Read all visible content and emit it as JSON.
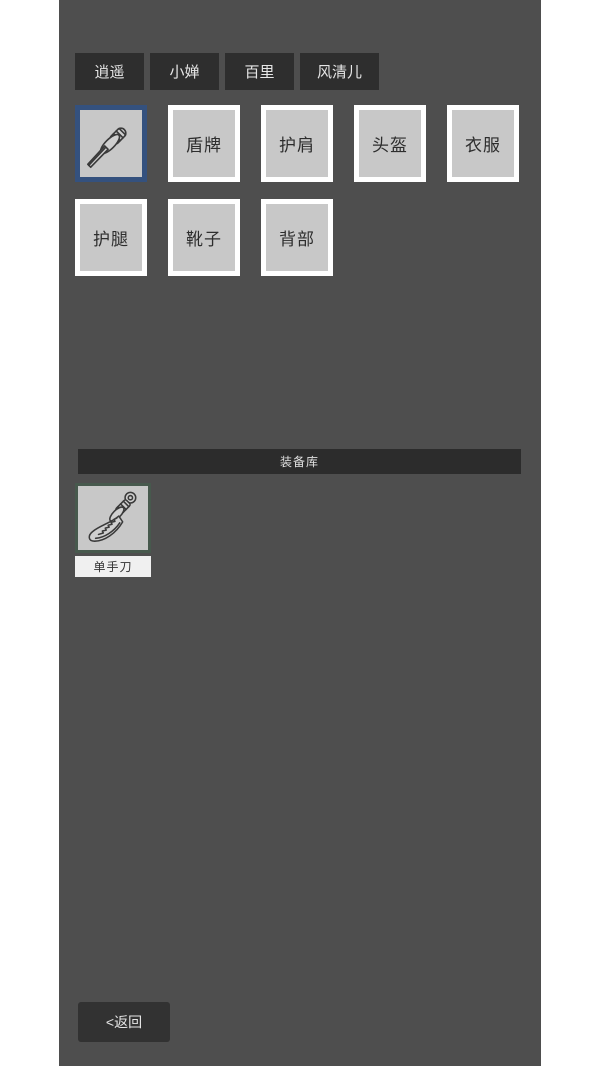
{
  "tabs": [
    {
      "label": "逍遥"
    },
    {
      "label": "小婵"
    },
    {
      "label": "百里"
    },
    {
      "label": "风清儿"
    }
  ],
  "equipment_slots": {
    "row1": [
      {
        "name": "weapon",
        "icon": "sword-icon",
        "selected": true,
        "label": ""
      },
      {
        "name": "shield",
        "label": "盾牌"
      },
      {
        "name": "shoulder",
        "label": "护肩"
      },
      {
        "name": "helmet",
        "label": "头盔"
      },
      {
        "name": "clothes",
        "label": "衣服"
      }
    ],
    "row2": [
      {
        "name": "legguards",
        "label": "护腿"
      },
      {
        "name": "boots",
        "label": "靴子"
      },
      {
        "name": "back",
        "label": "背部"
      }
    ]
  },
  "inventory": {
    "header": "装备库",
    "items": [
      {
        "name": "单手刀",
        "icon": "saber-icon"
      }
    ]
  },
  "back_button": {
    "label": "<返回"
  },
  "colors": {
    "page_bg": "#ffffff",
    "game_bg": "#4e4e4e",
    "tab_bg": "#2e2e2e",
    "slot_bg": "#c8c8c8",
    "slot_border": "#ffffff",
    "selected_slot_border": "#34517e",
    "inventory_item_border": "#47594d",
    "inventory_header_bg": "#2c2c2c",
    "item_label_bg": "#f0f0f0",
    "back_button_bg": "#323232"
  }
}
